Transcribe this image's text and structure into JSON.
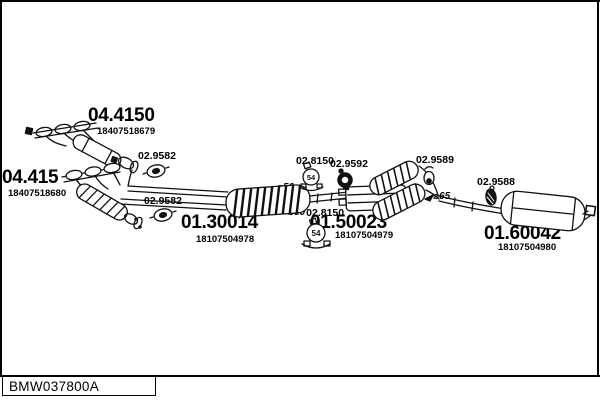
{
  "diagram_code": "BMW037800A",
  "parts": [
    {
      "number": "04.4150",
      "oem": "18407518679"
    },
    {
      "number": "04.415",
      "oem": "18407518680"
    },
    {
      "number": "01.30014",
      "oem": "18107504978"
    },
    {
      "number": "01.50023",
      "oem": "18107504979"
    },
    {
      "number": "01.60042",
      "oem": "18107504980"
    }
  ],
  "fittings": {
    "gasket_upper": "02.9582",
    "gasket_lower": "02.9582",
    "clamp_upper": "02.8150",
    "ring_gasket": "02.9592",
    "hanger_mid": "02.9589",
    "hanger_rear": "02.9588",
    "clamp_lower": "02.8150",
    "dia_50_upper": "⌀50",
    "dia_50_lower": "⌀50",
    "dia_65": "⌀65",
    "clamp_size": "54"
  }
}
